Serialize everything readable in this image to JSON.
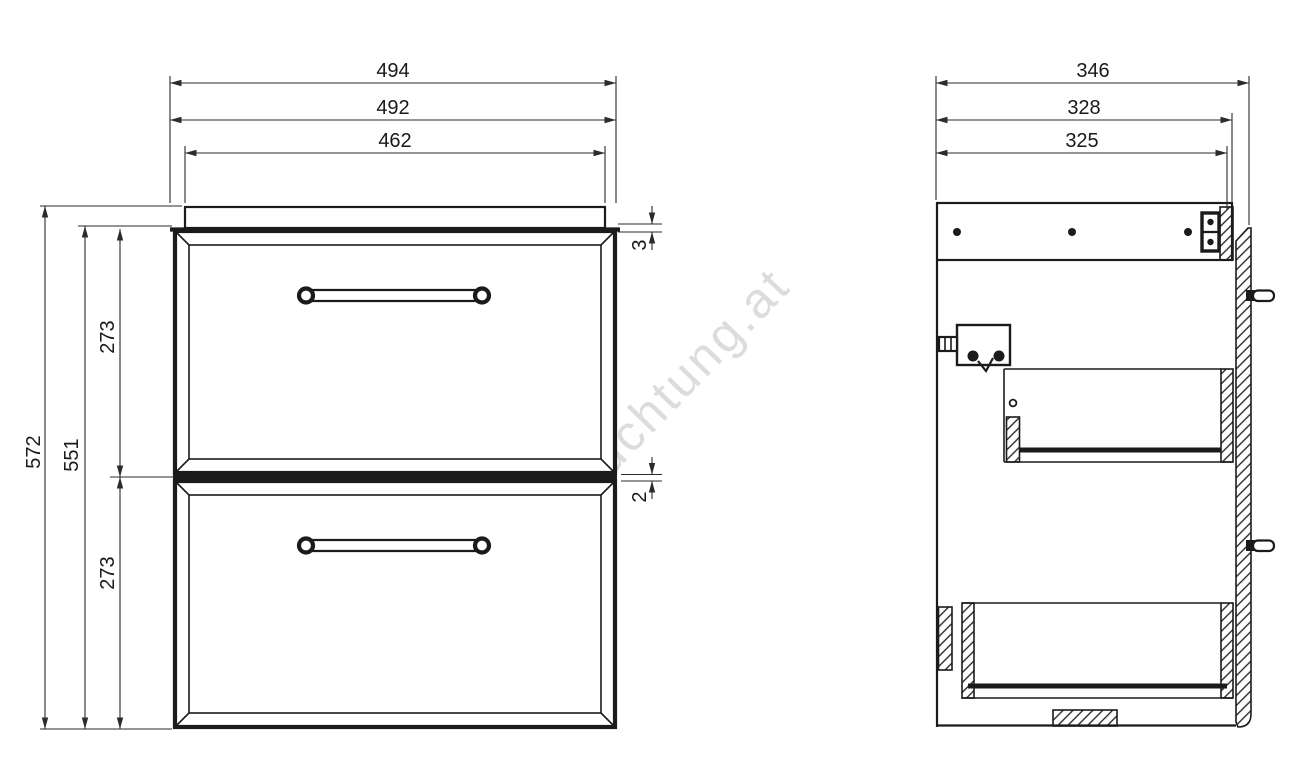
{
  "watermark": {
    "text": "beleuchtung.at",
    "color": "#dcdcdc"
  },
  "front_view": {
    "dims": {
      "overall_width": "494",
      "body_width": "492",
      "top_opening_width": "462",
      "overall_height": "572",
      "body_height": "551",
      "top_drawer_height": "273",
      "bottom_drawer_height": "273",
      "top_gap": "3",
      "drawer_gap": "2"
    }
  },
  "side_view": {
    "dims": {
      "overall_depth": "346",
      "body_depth": "328",
      "inner_depth": "325"
    }
  },
  "colors": {
    "line": "#1b1b1b",
    "dim_line": "#2b2b2b",
    "background": "#ffffff"
  }
}
